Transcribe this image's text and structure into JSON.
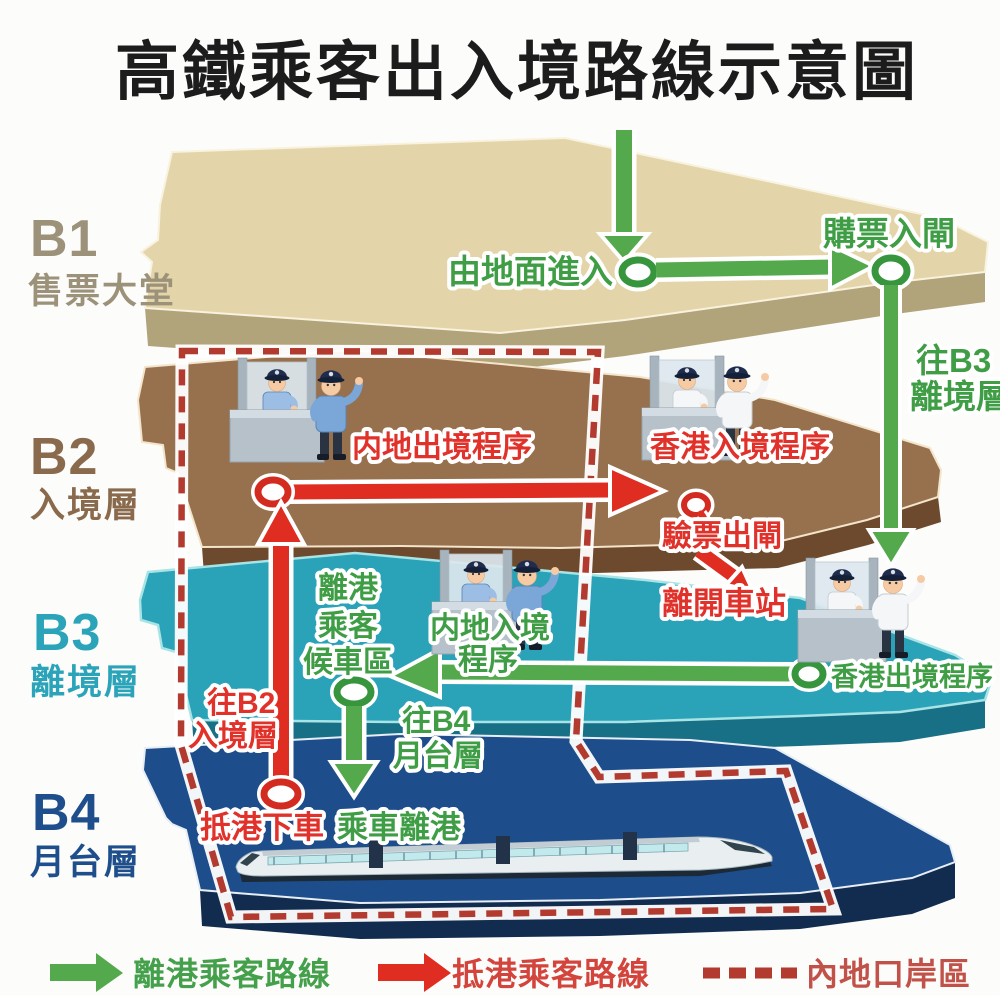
{
  "title": "高鐵乘客出入境路線示意圖",
  "levels": {
    "b1": {
      "id": "B1",
      "name": "售票大堂"
    },
    "b2": {
      "id": "B2",
      "name": "入境層"
    },
    "b3": {
      "id": "B3",
      "name": "離境層"
    },
    "b4": {
      "id": "B4",
      "name": "月台層"
    }
  },
  "routes": {
    "enter_from_ground": "由地面進入",
    "buy_ticket_enter_gate": "購票入閘",
    "to_b3_l1": "往B3",
    "to_b3_l2": "離境層",
    "mainland_exit_procedure": "内地出境程序",
    "hk_entry_procedure": "香港入境程序",
    "ticket_check_exit_gate": "驗票出閘",
    "leave_station": "離開車站",
    "waiting_l1": "離港",
    "waiting_l2": "乘客",
    "waiting_l3": "候車區",
    "mainland_entry_l1": "内地入境",
    "mainland_entry_l2": "程序",
    "hk_exit_procedure": "香港出境程序",
    "to_b2_l1": "往B2",
    "to_b2_l2": "入境層",
    "to_b4_l1": "往B4",
    "to_b4_l2": "月台層",
    "arrive_alight": "抵港下車",
    "board_depart": "乘車離港"
  },
  "legend": {
    "departing": "離港乘客路線",
    "arriving": "抵港乘客路線",
    "mainland_port_area": "內地口岸區"
  },
  "colors": {
    "departing_route_green": "#53a94c",
    "arriving_route_red": "#df2d22",
    "mainland_port_boundary_red": "#b23a2e",
    "b1_floor": "#e3d5a9",
    "b2_floor": "#97714d",
    "b3_floor": "#2aa2b8",
    "b4_floor": "#1d4d8a",
    "b1_label": "#9c927a",
    "b2_label": "#8a6a4c",
    "b3_label": "#2ba4ba",
    "b4_label": "#1e4f8c"
  },
  "icons": {
    "customs_booth": "customs-booth-icon",
    "officer_mainland": "mainland-officer-icon",
    "officer_hk": "hk-officer-icon",
    "train": "high-speed-train-icon",
    "route_node": "route-node-icon"
  }
}
